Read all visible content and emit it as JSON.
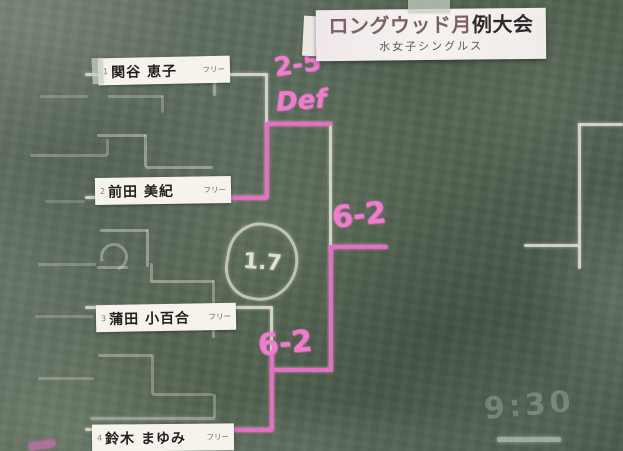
{
  "sign": {
    "title_part1": "ロングウッド月",
    "title_part2": "例大会",
    "subtitle": "水女子シングルス"
  },
  "players": [
    {
      "seed": "1",
      "name": "関谷 恵子",
      "status": "フリー"
    },
    {
      "seed": "2",
      "name": "前田 美紀",
      "status": "フリー"
    },
    {
      "seed": "3",
      "name": "蒲田 小百合",
      "status": "フリー"
    },
    {
      "seed": "4",
      "name": "鈴木 まゆみ",
      "status": "フリー"
    }
  ],
  "scores": {
    "round1_top": "2-5",
    "round1_top_note": "Def",
    "round1_bottom": "6-2",
    "final": "6-2"
  },
  "annotations": {
    "date_circled": "1.7",
    "ghost_time": "9:30"
  },
  "colors": {
    "chalk_white": "#ded9cf",
    "chalk_pink": "#e46cc2",
    "board_green": "#52624f"
  },
  "bracket": {
    "type": "single-elimination",
    "event": "ロングウッド月例大会",
    "division": "水女子シングルス",
    "matches": [
      {
        "round": 1,
        "player1": "関谷 恵子",
        "player2": "前田 美紀",
        "score": "2-5 Def",
        "winner": "前田 美紀"
      },
      {
        "round": 1,
        "player1": "蒲田 小百合",
        "player2": "鈴木 まゆみ",
        "score": "6-2",
        "winner": "鈴木 まゆみ"
      },
      {
        "round": 2,
        "player1": "前田 美紀",
        "player2": "鈴木 まゆみ",
        "score": "6-2",
        "winner": "鈴木 まゆみ"
      }
    ]
  }
}
